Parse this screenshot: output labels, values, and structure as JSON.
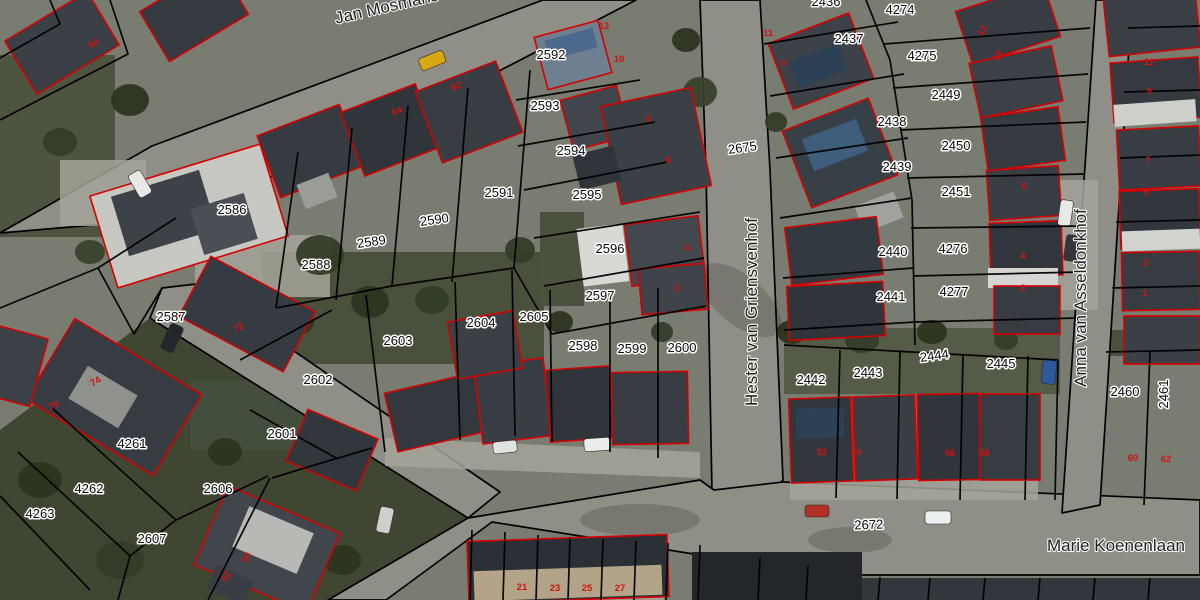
{
  "map": {
    "street_labels": [
      {
        "text": "Jan Mosmans",
        "x": 388,
        "y": 12,
        "rotation": -13,
        "size": 16
      },
      {
        "text": "Hester van Griensvenhof",
        "x": 757,
        "y": 312,
        "rotation": -90,
        "size": 17
      },
      {
        "text": "Anna van Asseldonkhof",
        "x": 1086,
        "y": 298,
        "rotation": -90,
        "size": 17
      },
      {
        "text": "Marie Koenenlaan",
        "x": 1116,
        "y": 551,
        "rotation": 0,
        "size": 17
      }
    ],
    "road_parcel_labels": [
      {
        "text": "2675",
        "x": 743,
        "y": 152,
        "rotation": -8
      },
      {
        "text": "2672",
        "x": 869,
        "y": 529,
        "rotation": -2
      }
    ],
    "parcel_labels": [
      {
        "text": "2586",
        "x": 232,
        "y": 214,
        "rotation": 0
      },
      {
        "text": "2588",
        "x": 316,
        "y": 269,
        "rotation": 0
      },
      {
        "text": "2589",
        "x": 372,
        "y": 246,
        "rotation": -8
      },
      {
        "text": "2590",
        "x": 435,
        "y": 224,
        "rotation": -8
      },
      {
        "text": "2587",
        "x": 171,
        "y": 321,
        "rotation": 0
      },
      {
        "text": "2591",
        "x": 499,
        "y": 197,
        "rotation": 0
      },
      {
        "text": "2592",
        "x": 551,
        "y": 59,
        "rotation": 0
      },
      {
        "text": "2593",
        "x": 545,
        "y": 110,
        "rotation": 0
      },
      {
        "text": "2594",
        "x": 571,
        "y": 155,
        "rotation": 0
      },
      {
        "text": "2595",
        "x": 587,
        "y": 199,
        "rotation": 0
      },
      {
        "text": "2596",
        "x": 610,
        "y": 253,
        "rotation": 0
      },
      {
        "text": "2597",
        "x": 600,
        "y": 300,
        "rotation": 0
      },
      {
        "text": "2598",
        "x": 583,
        "y": 350,
        "rotation": 0
      },
      {
        "text": "2599",
        "x": 632,
        "y": 353,
        "rotation": 0
      },
      {
        "text": "2600",
        "x": 682,
        "y": 352,
        "rotation": 0
      },
      {
        "text": "2601",
        "x": 282,
        "y": 438,
        "rotation": 0
      },
      {
        "text": "2602",
        "x": 318,
        "y": 384,
        "rotation": 0
      },
      {
        "text": "2603",
        "x": 398,
        "y": 345,
        "rotation": 0
      },
      {
        "text": "2604",
        "x": 481,
        "y": 327,
        "rotation": 0
      },
      {
        "text": "2605",
        "x": 534,
        "y": 321,
        "rotation": 0
      },
      {
        "text": "2606",
        "x": 218,
        "y": 493,
        "rotation": 0
      },
      {
        "text": "2607",
        "x": 152,
        "y": 543,
        "rotation": 0
      },
      {
        "text": "4261",
        "x": 132,
        "y": 448,
        "rotation": 0
      },
      {
        "text": "4262",
        "x": 89,
        "y": 493,
        "rotation": 0
      },
      {
        "text": "4263",
        "x": 40,
        "y": 518,
        "rotation": 0
      },
      {
        "text": "2436",
        "x": 826,
        "y": 6,
        "rotation": 0
      },
      {
        "text": "2437",
        "x": 849,
        "y": 43,
        "rotation": 0
      },
      {
        "text": "2438",
        "x": 892,
        "y": 126,
        "rotation": 0
      },
      {
        "text": "2439",
        "x": 897,
        "y": 171,
        "rotation": 0
      },
      {
        "text": "2440",
        "x": 893,
        "y": 256,
        "rotation": 0
      },
      {
        "text": "2441",
        "x": 891,
        "y": 301,
        "rotation": 0
      },
      {
        "text": "2442",
        "x": 811,
        "y": 384,
        "rotation": 0
      },
      {
        "text": "2443",
        "x": 868,
        "y": 377,
        "rotation": 0
      },
      {
        "text": "2444",
        "x": 935,
        "y": 360,
        "rotation": -8
      },
      {
        "text": "2445",
        "x": 1001,
        "y": 368,
        "rotation": 0
      },
      {
        "text": "2449",
        "x": 946,
        "y": 99,
        "rotation": 0
      },
      {
        "text": "2450",
        "x": 956,
        "y": 150,
        "rotation": 0
      },
      {
        "text": "2451",
        "x": 956,
        "y": 196,
        "rotation": 0
      },
      {
        "text": "4274",
        "x": 900,
        "y": 14,
        "rotation": 0
      },
      {
        "text": "4275",
        "x": 922,
        "y": 60,
        "rotation": 0
      },
      {
        "text": "4276",
        "x": 953,
        "y": 253,
        "rotation": 0
      },
      {
        "text": "4277",
        "x": 954,
        "y": 296,
        "rotation": 0
      },
      {
        "text": "2460",
        "x": 1125,
        "y": 396,
        "rotation": 0
      },
      {
        "text": "2461",
        "x": 1168,
        "y": 394,
        "rotation": -90
      }
    ],
    "house_number_labels": [
      {
        "text": "84",
        "x": 95,
        "y": 46,
        "rotation": -30
      },
      {
        "text": "64",
        "x": 398,
        "y": 114,
        "rotation": -20
      },
      {
        "text": "62",
        "x": 457,
        "y": 89,
        "rotation": -20
      },
      {
        "text": "12",
        "x": 604,
        "y": 29,
        "rotation": 0
      },
      {
        "text": "10",
        "x": 619,
        "y": 62,
        "rotation": 0
      },
      {
        "text": "8",
        "x": 648,
        "y": 122,
        "rotation": 0
      },
      {
        "text": "6",
        "x": 668,
        "y": 163,
        "rotation": 0
      },
      {
        "text": "4",
        "x": 687,
        "y": 251,
        "rotation": 0
      },
      {
        "text": "2",
        "x": 677,
        "y": 291,
        "rotation": 0
      },
      {
        "text": "11",
        "x": 768,
        "y": 36,
        "rotation": 0
      },
      {
        "text": "9",
        "x": 783,
        "y": 66,
        "rotation": 0
      },
      {
        "text": "72",
        "x": 240,
        "y": 330,
        "rotation": -28
      },
      {
        "text": "74",
        "x": 97,
        "y": 384,
        "rotation": -30
      },
      {
        "text": "76",
        "x": 55,
        "y": 408,
        "rotation": -30
      },
      {
        "text": "12",
        "x": 985,
        "y": 32,
        "rotation": -60
      },
      {
        "text": "10",
        "x": 1000,
        "y": 57,
        "rotation": -60
      },
      {
        "text": "6",
        "x": 1024,
        "y": 189,
        "rotation": 0
      },
      {
        "text": "4",
        "x": 1023,
        "y": 259,
        "rotation": 0
      },
      {
        "text": "2",
        "x": 1023,
        "y": 291,
        "rotation": 0
      },
      {
        "text": "11",
        "x": 1149,
        "y": 65,
        "rotation": 0
      },
      {
        "text": "9",
        "x": 1149,
        "y": 94,
        "rotation": 0
      },
      {
        "text": "7",
        "x": 1148,
        "y": 163,
        "rotation": 0
      },
      {
        "text": "5",
        "x": 1146,
        "y": 195,
        "rotation": 0
      },
      {
        "text": "3",
        "x": 1146,
        "y": 266,
        "rotation": 0
      },
      {
        "text": "1",
        "x": 1145,
        "y": 296,
        "rotation": 0
      },
      {
        "text": "52",
        "x": 822,
        "y": 455,
        "rotation": 0
      },
      {
        "text": "54",
        "x": 856,
        "y": 455,
        "rotation": 0
      },
      {
        "text": "56",
        "x": 950,
        "y": 456,
        "rotation": 0
      },
      {
        "text": "58",
        "x": 984,
        "y": 456,
        "rotation": 0
      },
      {
        "text": "60",
        "x": 1133,
        "y": 461,
        "rotation": 0
      },
      {
        "text": "62",
        "x": 1166,
        "y": 462,
        "rotation": 0
      },
      {
        "text": "21",
        "x": 522,
        "y": 590,
        "rotation": 0
      },
      {
        "text": "23",
        "x": 555,
        "y": 591,
        "rotation": 0
      },
      {
        "text": "25",
        "x": 587,
        "y": 591,
        "rotation": 0
      },
      {
        "text": "27",
        "x": 620,
        "y": 591,
        "rotation": 0
      },
      {
        "text": "50",
        "x": 249,
        "y": 559,
        "rotation": -60
      },
      {
        "text": "52",
        "x": 229,
        "y": 578,
        "rotation": -60
      }
    ],
    "legend_colors": {
      "parcel_boundary": "#000000",
      "building_outline": "#d60000",
      "label_text": "#0a0a0a",
      "label_halo": "#ffffff"
    }
  }
}
